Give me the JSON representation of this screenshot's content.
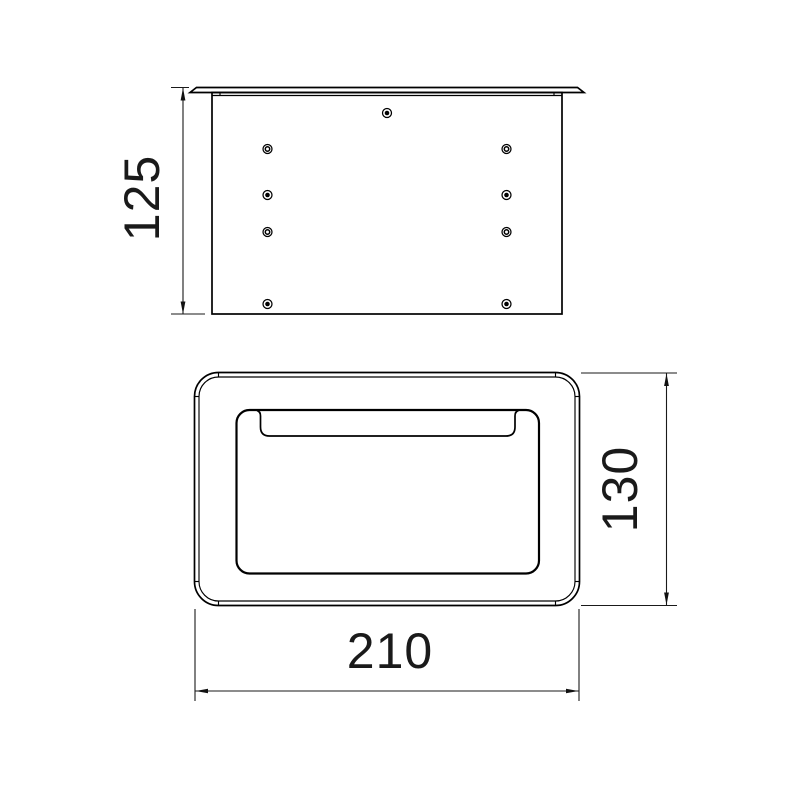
{
  "colors": {
    "background": "#ffffff",
    "line": "#000000",
    "text": "#1a1a1a"
  },
  "views": {
    "side_view": {
      "dimension_height": "125",
      "fasteners": [
        {
          "x": 387,
          "y": 113,
          "style": "filled"
        },
        {
          "x": 267.5,
          "y": 149,
          "style": "open"
        },
        {
          "x": 506.5,
          "y": 149,
          "style": "open"
        },
        {
          "x": 267.5,
          "y": 195,
          "style": "filled"
        },
        {
          "x": 506.5,
          "y": 195,
          "style": "filled"
        },
        {
          "x": 267.5,
          "y": 232,
          "style": "open"
        },
        {
          "x": 506.5,
          "y": 232,
          "style": "open"
        },
        {
          "x": 267.5,
          "y": 304,
          "style": "filled"
        },
        {
          "x": 506.5,
          "y": 304,
          "style": "filled"
        }
      ]
    },
    "plan_view": {
      "dimension_width": "210",
      "dimension_height": "130"
    }
  }
}
